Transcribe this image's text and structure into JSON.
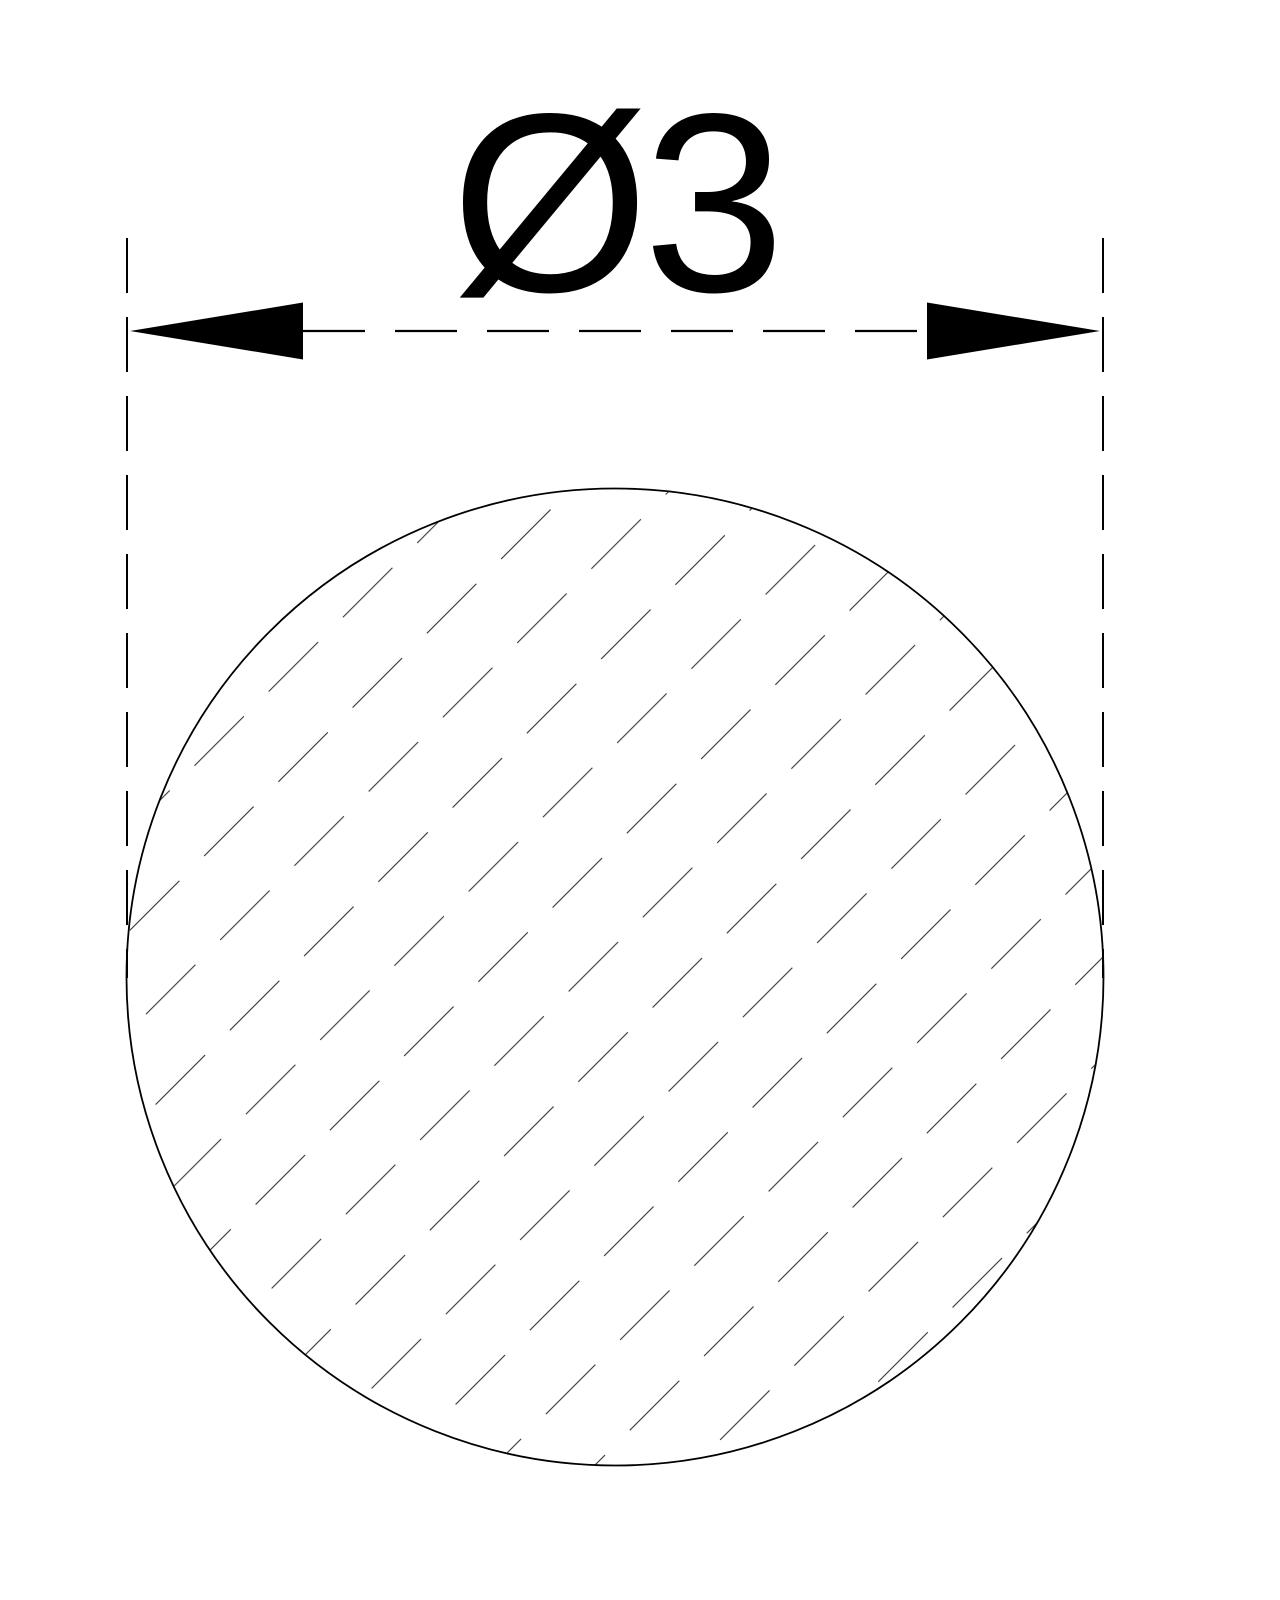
{
  "drawing": {
    "kind": "technical-cross-section",
    "dimension": {
      "label": "Ø3",
      "symbol": "Ø",
      "value": "3",
      "measure": "diameter"
    },
    "colors": {
      "background": "#ffffff",
      "line": "#000000",
      "hatch": "#222222"
    },
    "geometry": {
      "circle_center_x": 615,
      "circle_center_y": 977,
      "circle_radius": 488,
      "dimension_line_y": 331,
      "extension_line_left_x": 127,
      "extension_line_right_x": 1103,
      "hatch_angle_deg": 45
    }
  }
}
